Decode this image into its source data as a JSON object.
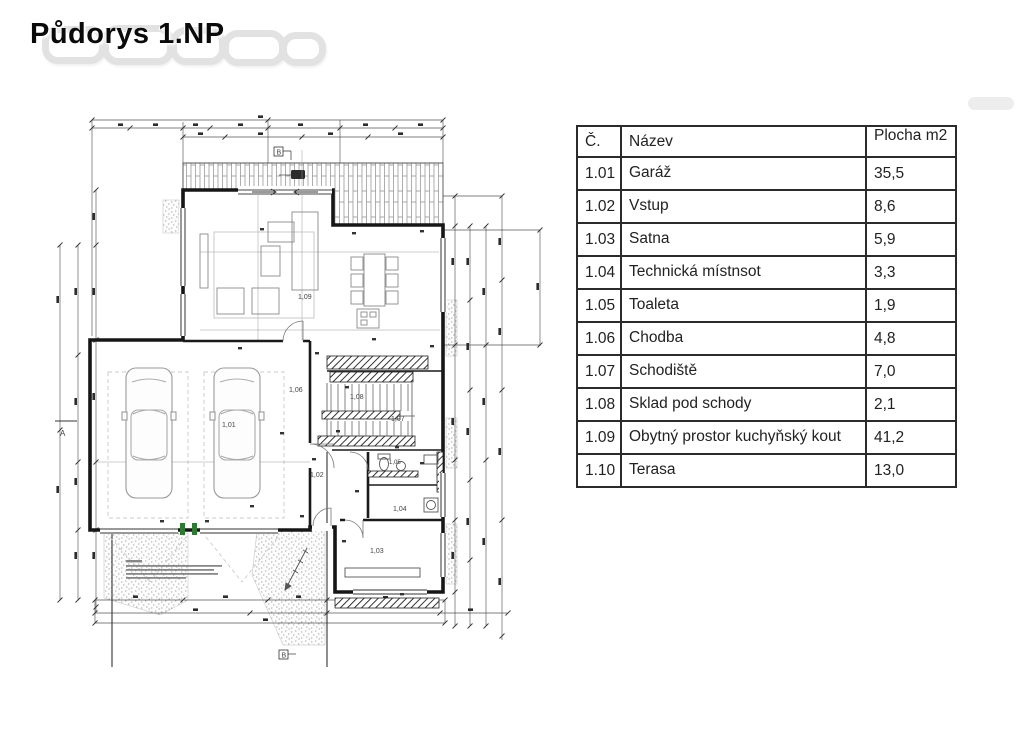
{
  "page": {
    "title": "Půdorys 1.NP"
  },
  "table": {
    "headers": {
      "number": "Č.",
      "name": "Název",
      "area": "Plocha m2"
    },
    "rows": [
      {
        "number": "1.01",
        "name": "Garáž",
        "area": "35,5"
      },
      {
        "number": "1.02",
        "name": "Vstup",
        "area": "8,6"
      },
      {
        "number": "1.03",
        "name": "Šatna",
        "area": "5,9"
      },
      {
        "number": "1.04",
        "name": "Technická místnsot",
        "area": "3,3"
      },
      {
        "number": "1.05",
        "name": "Toaleta",
        "area": "1,9"
      },
      {
        "number": "1.06",
        "name": "Chodba",
        "area": "4,8"
      },
      {
        "number": "1.07",
        "name": "Schodiště",
        "area": "7,0"
      },
      {
        "number": "1.08",
        "name": "Sklad pod schody",
        "area": "2,1"
      },
      {
        "number": "1.09",
        "name": "Obytný prostor kuchyňský kout",
        "area": "41,2"
      },
      {
        "number": "1.10",
        "name": "Terasa",
        "area": "13,0"
      }
    ]
  },
  "plan": {
    "rooms": {
      "r101": "1,01",
      "r102": "1,02",
      "r103": "1,03",
      "r104": "1,04",
      "r105": "1,05",
      "r106": "1,06",
      "r107": "1,07",
      "r108": "1,08",
      "r109": "1,09"
    },
    "section_markers": {
      "a": "A",
      "b": "B"
    }
  },
  "colors": {
    "linework": "#1a1a1a",
    "dimension": "#555555",
    "accent_green": "#2f7a33"
  }
}
